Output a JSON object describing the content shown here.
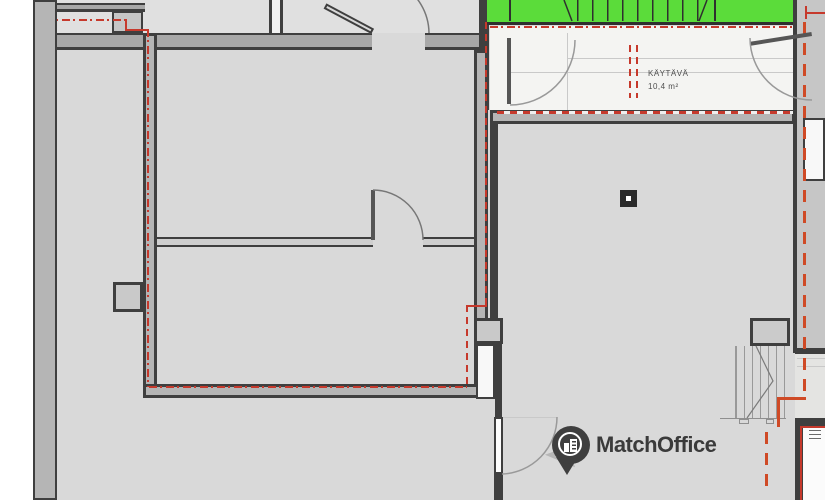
{
  "corridor": {
    "label": "KÄYTÄVÄ",
    "area": "10,4 m²"
  },
  "watermark": {
    "brand": "MatchOffice",
    "icon": "building-location-pin-icon"
  },
  "colors": {
    "stairwell_highlight_green": "#5bdc3a",
    "boundary_red": "#c6392c",
    "accent_orange": "#cf4a26",
    "wall_dark": "#3f3f3f",
    "floor_gray": "#d9d9d9",
    "corridor_white": "#f4f4f2",
    "logo_gray": "#3b3b3b"
  }
}
